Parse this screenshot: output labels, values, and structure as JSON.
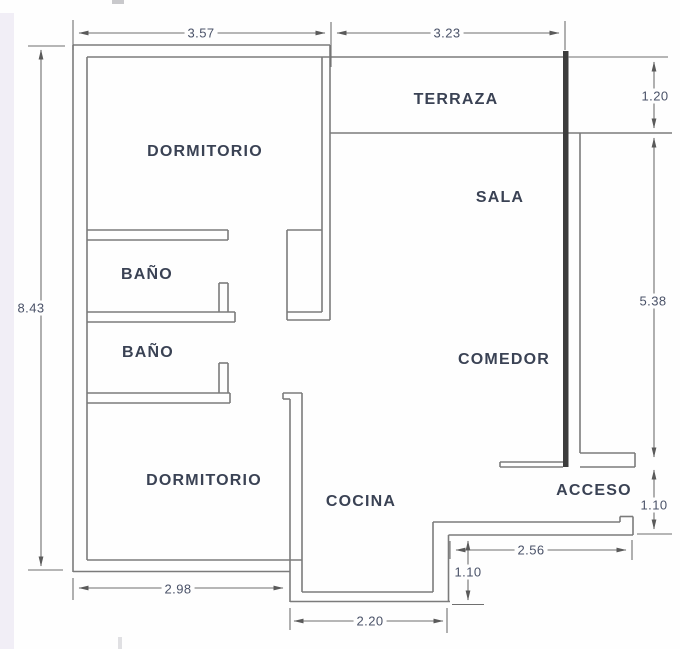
{
  "plan": {
    "type": "apartment-floor-plan",
    "rooms": [
      {
        "label": "DORMITORIO"
      },
      {
        "label": "TERRAZA"
      },
      {
        "label": "SALA"
      },
      {
        "label": "BAÑO"
      },
      {
        "label": "BAÑO"
      },
      {
        "label": "COMEDOR"
      },
      {
        "label": "DORMITORIO"
      },
      {
        "label": "COCINA"
      },
      {
        "label": "ACCESO"
      }
    ],
    "dimensions": [
      {
        "name": "width-top-left",
        "value": "3.57"
      },
      {
        "name": "width-top-right",
        "value": "3.23"
      },
      {
        "name": "terraza-depth",
        "value": "1.20"
      },
      {
        "name": "total-height-left",
        "value": "8.43"
      },
      {
        "name": "sala-comedor-height",
        "value": "5.38"
      },
      {
        "name": "acceso-opening-height",
        "value": "1.10"
      },
      {
        "name": "entry-wall-length",
        "value": "2.56"
      },
      {
        "name": "kitchen-recess-depth",
        "value": "1.10"
      },
      {
        "name": "width-bottom-left",
        "value": "2.98"
      },
      {
        "name": "kitchen-bottom-width",
        "value": "2.20"
      }
    ],
    "colors": {
      "wall_line": "#7b7b7b",
      "wall_thick": "#3c3c3c",
      "dimension_line": "#6f6f6f",
      "room_text": "#3a4254",
      "dimension_text": "#4a5268",
      "background": "#fefefe",
      "page_edge": "#f1eef6"
    }
  }
}
